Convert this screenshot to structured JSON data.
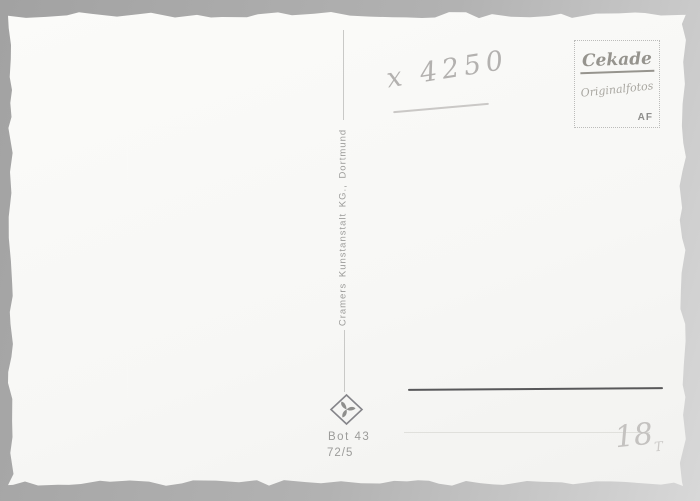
{
  "card": {
    "handwritten_number": "x 4250",
    "stamp_box": {
      "brand": "Cekade",
      "subtitle": "Originalfotos",
      "initials": "AF"
    },
    "publisher": "Cramers Kunstanstalt KG., Dortmund",
    "print_code_1": "Bot 43",
    "print_code_2": "72/5",
    "pencil_mark": "18",
    "pencil_mark_sub": "T"
  },
  "icons": {
    "publisher_logo": "diamond-pinwheel-logo"
  },
  "colors": {
    "background_gray": "#b2b2b2",
    "card_white": "#f8f8f6",
    "print_gray": "#9b9b99",
    "pencil_gray": "#b3b1af",
    "address_line_dark": "#58585a",
    "stamp_gray": "#96948e"
  }
}
